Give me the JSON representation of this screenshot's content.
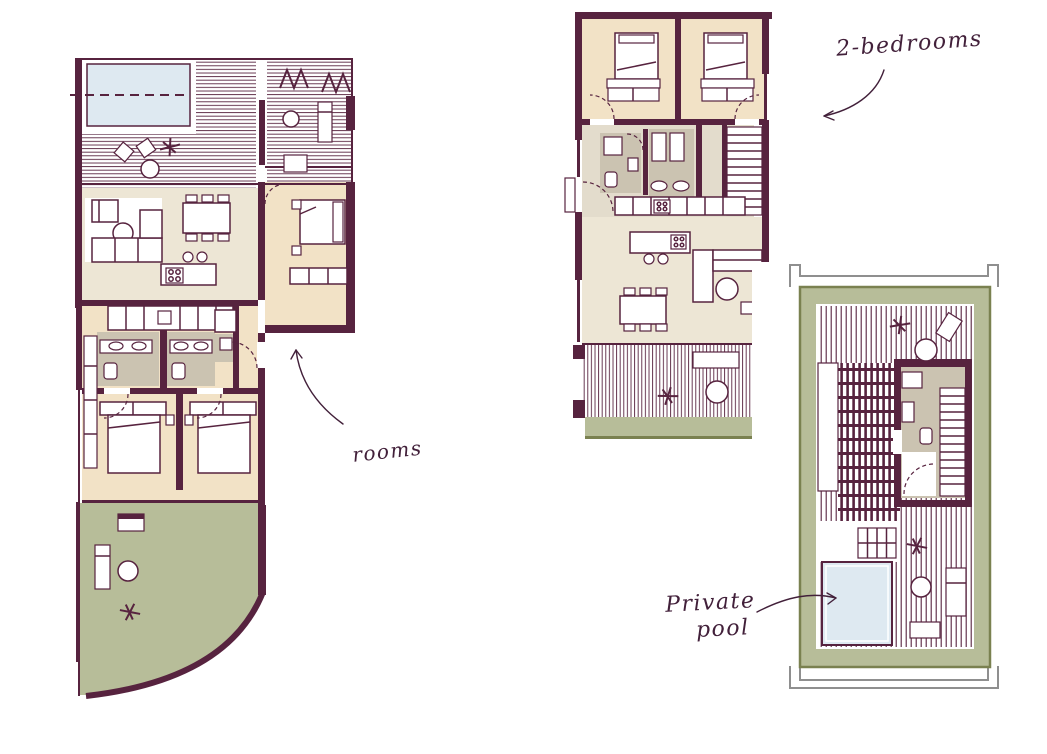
{
  "figure": {
    "type": "architectural-floor-plans",
    "background": "#FFFFFF"
  },
  "palette": {
    "wall": "#57233F",
    "bedroom_floor": "#F2E2C6",
    "living_floor": "#EDE6D5",
    "bathroom_floor": "#CBC3B1",
    "corridor_floor": "#E3DCCC",
    "garden_green": "#B7BD99",
    "garden_border": "#7A8150",
    "pool_blue": "#DEE9F1",
    "frame_gray": "#8F8F8F",
    "handwriting_ink": "#42203A"
  },
  "annotations": {
    "two_bedrooms": {
      "text": "2-bedrooms"
    },
    "rooms": {
      "text": "rooms"
    },
    "private_pool": {
      "line1": "Private",
      "line2": "pool"
    }
  }
}
